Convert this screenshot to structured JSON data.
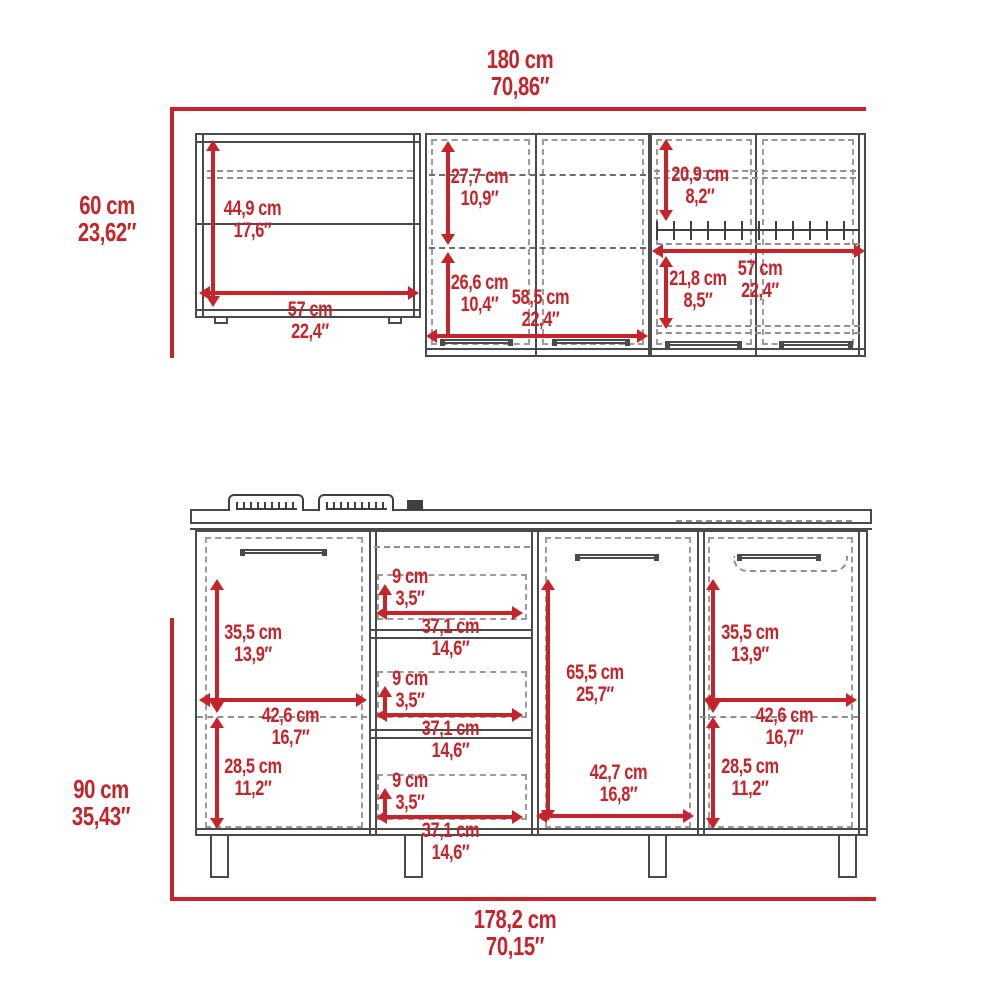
{
  "colors": {
    "dimension_red": "#c5242b",
    "cabinet_line": "#4a4a4a",
    "dashed_line": "#8f8f8f",
    "background": "#ffffff"
  },
  "upper_drawing": {
    "overall_width": {
      "cm": "180 cm",
      "inches": "70,86″"
    },
    "overall_height": {
      "cm": "60 cm",
      "inches": "23,62″"
    },
    "open_shelf_height": {
      "cm": "44,9 cm",
      "inches": "17,6″"
    },
    "open_shelf_width": {
      "cm": "57 cm",
      "inches": "22,4″"
    },
    "middle_upper_height": {
      "cm": "27,7 cm",
      "inches": "10,9″"
    },
    "middle_lower_height": {
      "cm": "26,6 cm",
      "inches": "10,4″"
    },
    "middle_width": {
      "cm": "58,5 cm",
      "inches": "22,4″"
    },
    "right_upper_height": {
      "cm": "20,9 cm",
      "inches": "8,2″"
    },
    "right_lower_height": {
      "cm": "21,8 cm",
      "inches": "8,5″"
    },
    "right_width": {
      "cm": "57 cm",
      "inches": "22,4″"
    }
  },
  "lower_drawing": {
    "overall_width": {
      "cm": "178,2 cm",
      "inches": "70,15″"
    },
    "overall_height": {
      "cm": "90 cm",
      "inches": "35,43″"
    },
    "left_door_upper_height": {
      "cm": "35,5 cm",
      "inches": "13,9″"
    },
    "left_door_width": {
      "cm": "42,6 cm",
      "inches": "16,7″"
    },
    "left_door_lower_height": {
      "cm": "28,5 cm",
      "inches": "11,2″"
    },
    "drawers": [
      {
        "height": {
          "cm": "9 cm",
          "inches": "3,5″"
        },
        "width": {
          "cm": "37,1 cm",
          "inches": "14,6″"
        }
      },
      {
        "height": {
          "cm": "9 cm",
          "inches": "3,5″"
        },
        "width": {
          "cm": "37,1 cm",
          "inches": "14,6″"
        }
      },
      {
        "height": {
          "cm": "9 cm",
          "inches": "3,5″"
        },
        "width": {
          "cm": "37,1 cm",
          "inches": "14,6″"
        }
      }
    ],
    "middle_door_height": {
      "cm": "65,5 cm",
      "inches": "25,7″"
    },
    "middle_door_width": {
      "cm": "42,7 cm",
      "inches": "16,8″"
    },
    "right_door_upper_height": {
      "cm": "35,5 cm",
      "inches": "13,9″"
    },
    "right_door_width": {
      "cm": "42,6 cm",
      "inches": "16,7″"
    },
    "right_door_lower_height": {
      "cm": "28,5 cm",
      "inches": "11,2″"
    }
  }
}
